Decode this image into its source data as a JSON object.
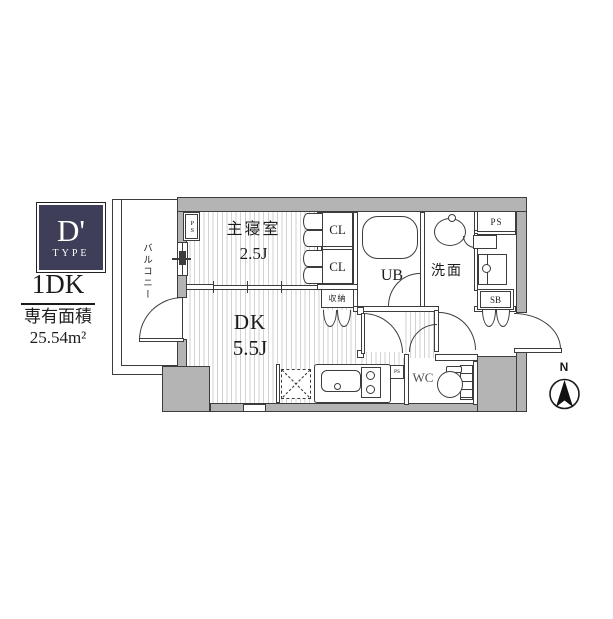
{
  "panel": {
    "type_letter": "D'",
    "type_word": "TYPE",
    "layout": "1DK",
    "area_label": "専有面積",
    "area_value": "25.54m²"
  },
  "rooms": {
    "bedroom": {
      "name": "主寝室",
      "size": "2.5J"
    },
    "dining_kitchen": {
      "name": "DK",
      "size": "5.5J"
    },
    "closet1": "CL",
    "closet2": "CL",
    "storage": "収納",
    "unit_bath": "UB",
    "washroom": "洗面",
    "toilet": "WC",
    "shoe_box": "SB",
    "balcony": "バルコニー"
  },
  "pipe_spaces": {
    "bedroom": "PS",
    "top_right": "PS",
    "kitchen": "PS"
  },
  "compass": {
    "north": "N"
  },
  "colors": {
    "badge": "#3e3e59",
    "wall_fill": "#b4b4b4",
    "line": "#3c3c3c",
    "floor_stripe": "#d2d2d2"
  }
}
